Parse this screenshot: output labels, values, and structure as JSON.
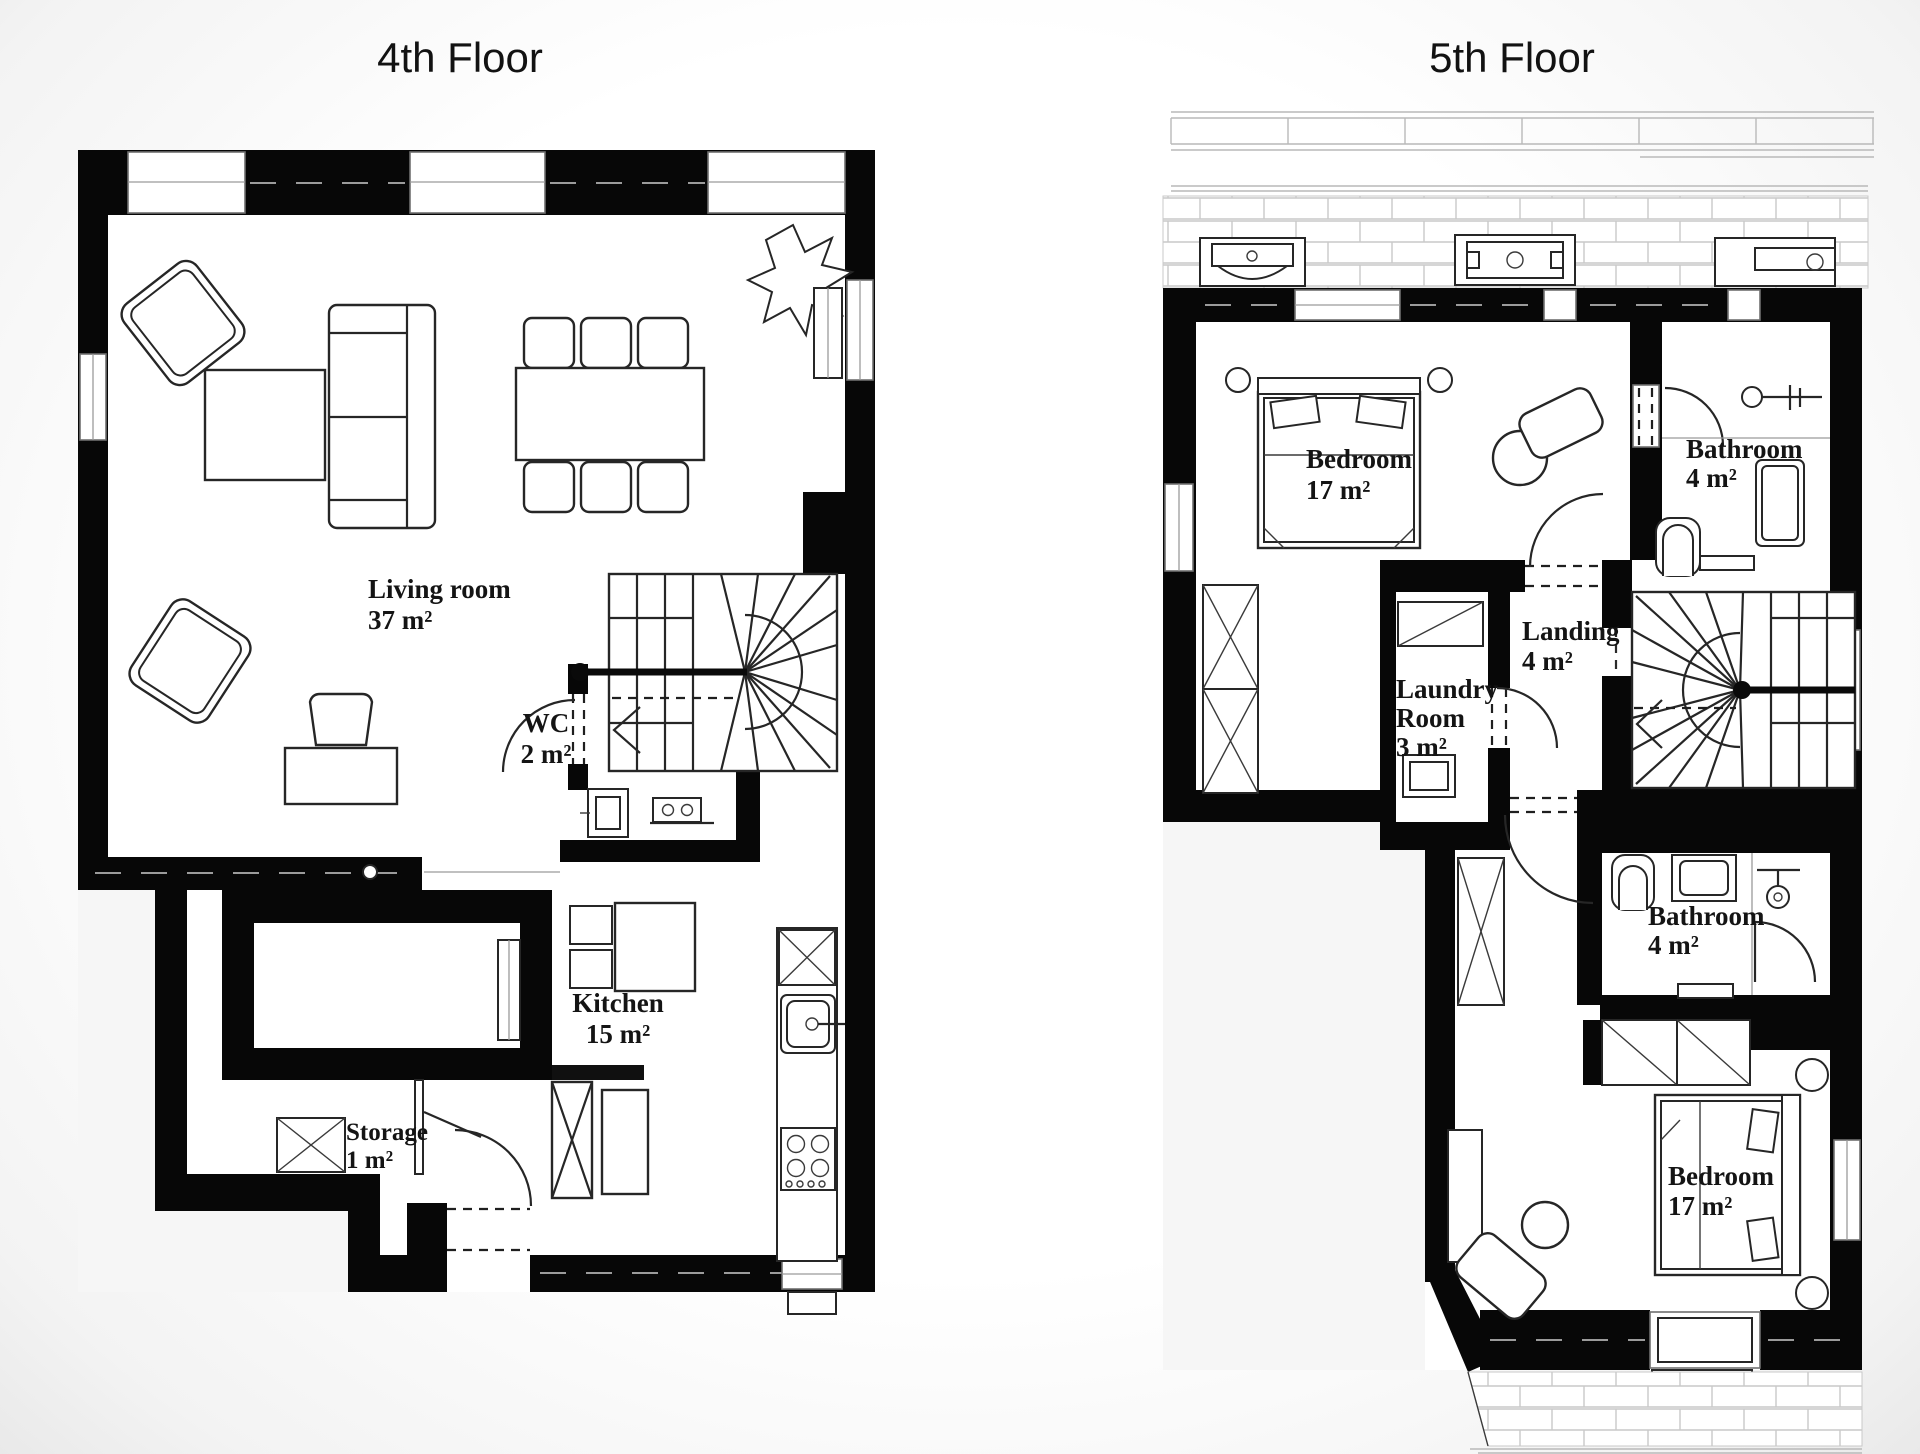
{
  "titles": {
    "floor4": "4th Floor",
    "floor5": "5th Floor"
  },
  "floor4": {
    "rooms": [
      {
        "id": "living-room",
        "lines": [
          "Living room",
          "37 m²"
        ]
      },
      {
        "id": "wc",
        "lines": [
          "WC",
          "2 m²"
        ]
      },
      {
        "id": "kitchen",
        "lines": [
          "Kitchen",
          "15 m²"
        ]
      },
      {
        "id": "storage",
        "lines": [
          "Storage",
          "1 m²"
        ]
      }
    ]
  },
  "floor5": {
    "rooms": [
      {
        "id": "bedroom-top",
        "lines": [
          "Bedroom",
          "17 m²"
        ]
      },
      {
        "id": "bathroom-top",
        "lines": [
          "Bathroom",
          "4 m²"
        ]
      },
      {
        "id": "landing",
        "lines": [
          "Landing",
          "4 m²"
        ]
      },
      {
        "id": "laundry-room",
        "lines": [
          "Laundry",
          "Room",
          "3 m²"
        ]
      },
      {
        "id": "bathroom-bottom",
        "lines": [
          "Bathroom",
          "4 m²"
        ]
      },
      {
        "id": "bedroom-bottom",
        "lines": [
          "Bedroom",
          "17 m²"
        ]
      }
    ]
  },
  "colors": {
    "wall": "#070707",
    "line": "#262626",
    "room_fill": "#ffffff",
    "muted_line": "#c9c9c9"
  }
}
